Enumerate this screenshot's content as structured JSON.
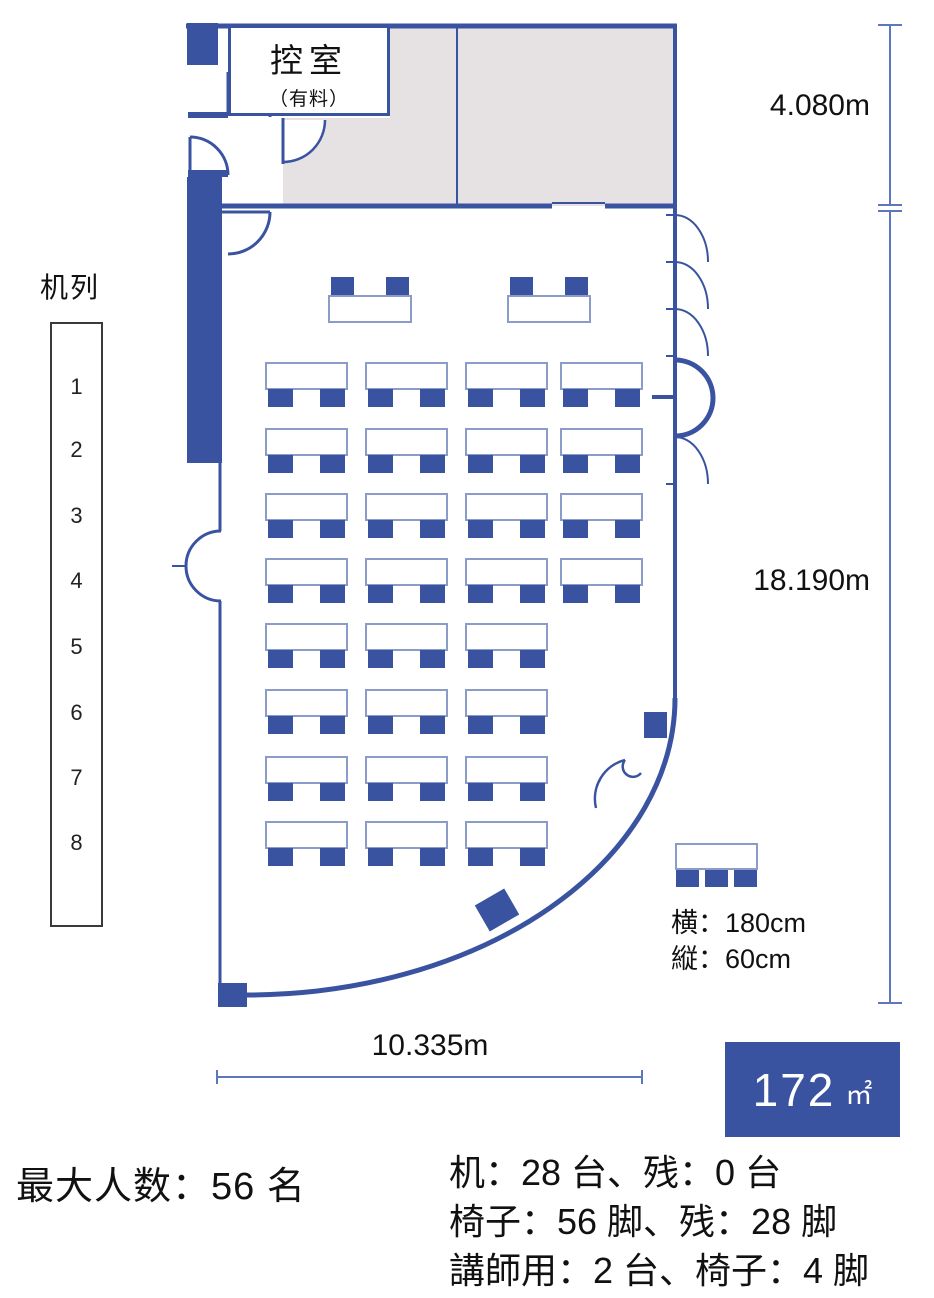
{
  "waiting_room": {
    "name": "控室",
    "note": "（有料）"
  },
  "desk_rows_panel": {
    "title": "机列",
    "numbers": [
      "1",
      "2",
      "3",
      "4",
      "5",
      "6",
      "7",
      "8"
    ]
  },
  "dimensions": {
    "annex_height": "4.080m",
    "room_height": "18.190m",
    "room_width": "10.335m"
  },
  "desk_spec": {
    "width_label": "横：180cm",
    "depth_label": "縦：60cm"
  },
  "area_badge": {
    "value": "172",
    "unit": "㎡"
  },
  "summary": {
    "max_capacity": "最大人数：56 名"
  },
  "inventory": {
    "lines": [
      "机：28 台、残：0 台",
      "椅子：56 脚、残：28 脚",
      "講師用：2 台、椅子：4 脚"
    ]
  },
  "floor_plan": {
    "lecturer_desk_count": 2,
    "student_rows": [
      4,
      4,
      4,
      4,
      3,
      3,
      3,
      3
    ],
    "chairs_per_desk": 2,
    "legend_chair_count": 3
  },
  "colors": {
    "wall": "#3A53A0",
    "desk_border": "#8C9CC8",
    "chair": "#3A53A0",
    "annex_fill": "#E6E1E3",
    "dimension_line": "#5C77BC",
    "badge_bg": "#3A53A0",
    "text": "#111111"
  }
}
